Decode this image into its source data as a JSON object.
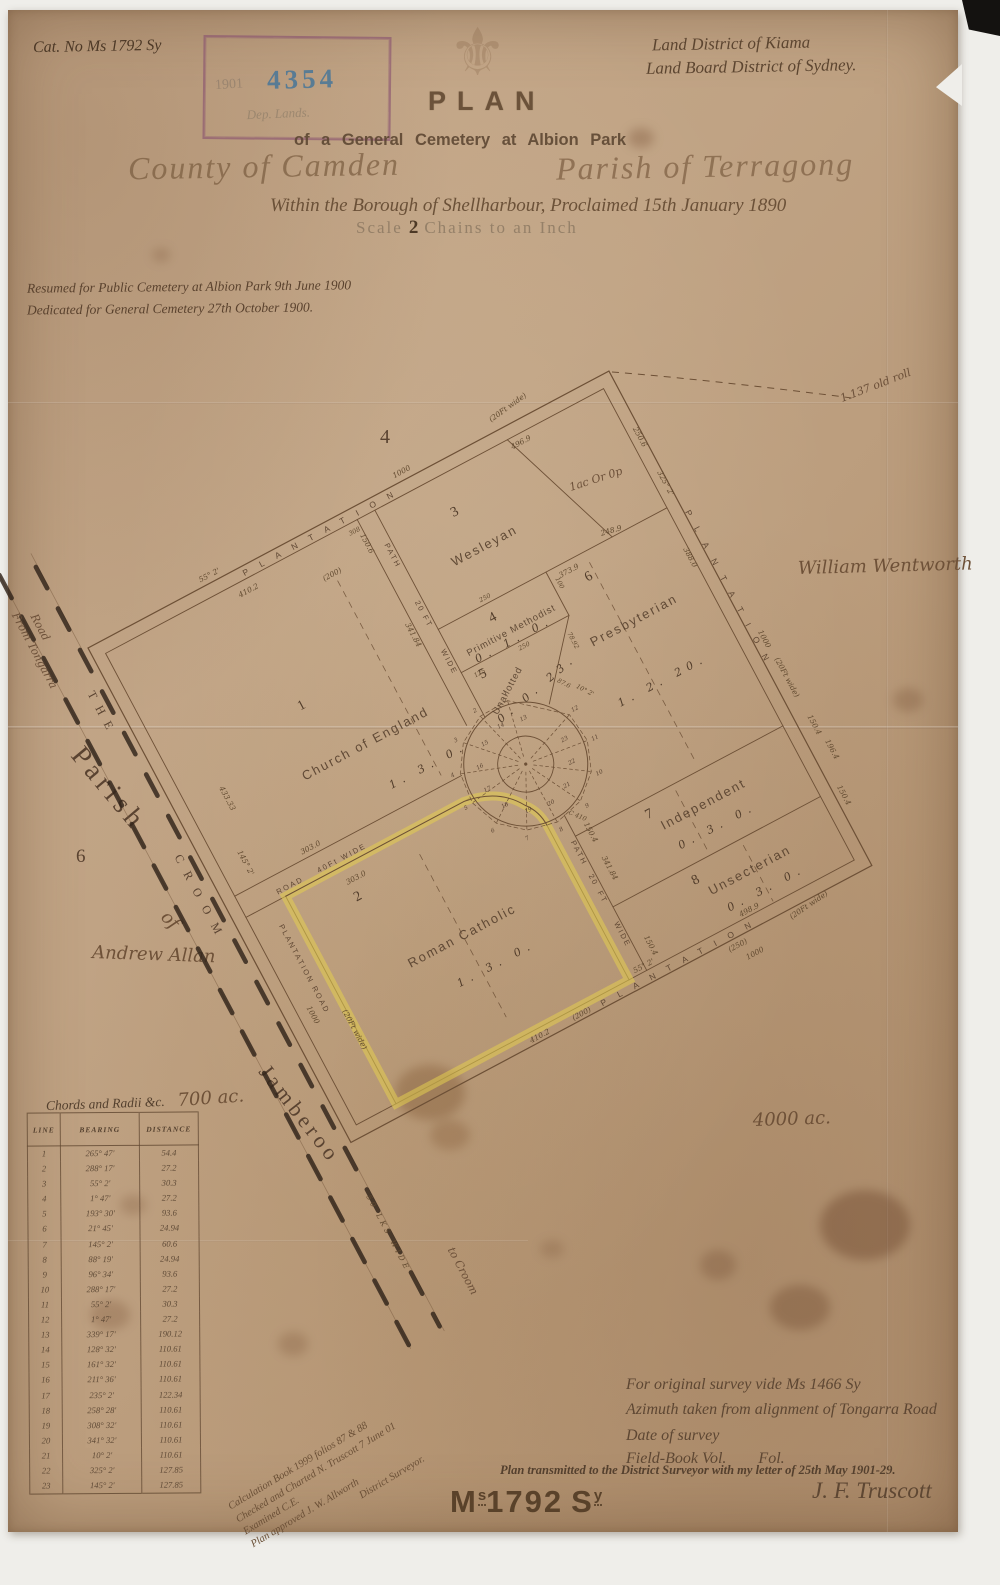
{
  "page": {
    "catalog_no": "Cat. No Ms 1792 Sy"
  },
  "icons": {
    "fleur": "⚜"
  },
  "stamp": {
    "year": "1901",
    "number": "4354",
    "dept": "Dep. Lands."
  },
  "header": {
    "district_line1": "Land District of Kiama",
    "district_line2": "Land Board District of Sydney.",
    "title": "PLAN",
    "subtitle": "of a General Cemetery at Albion Park",
    "county": "County of Camden",
    "parish": "Parish of Terragong",
    "borough": "Within the Borough of Shellharbour, Proclaimed 15th January 1890",
    "scale_label": "Scale",
    "scale_value": "2",
    "scale_units": "Chains to an Inch",
    "resumed": "Resumed for Public Cemetery at Albion Park 9th June 1900",
    "dedicated": "Dedicated for General Cemetery 27th October 1900."
  },
  "map": {
    "portion_number": "4",
    "old_roll_note": "1.137 old roll",
    "unnumbered_area": "1ac Or 0p",
    "adjoining": {
      "east_owner": "William Wentworth",
      "parish_label": "Parish",
      "parish_portion": "6",
      "of_label": "of",
      "west_owner": "Andrew Allan",
      "south_name": "Jamberoo",
      "area_west": "700 ac.",
      "area_south": "4000 ac."
    },
    "road": {
      "from_label1": "From Tongarra",
      "from_label2": "Road",
      "name_the": "THE",
      "name_croom": "CROOM",
      "width_label": "50 LKS WIDE",
      "to_label": "to Croom"
    },
    "plots": [
      {
        "num": "1",
        "name": "Church of England",
        "area": "1. 3. 0.",
        "note": "(200)"
      },
      {
        "num": "2",
        "name": "Roman Catholic",
        "area": "1. 3. 0."
      },
      {
        "num": "3",
        "name": "Wesleyan",
        "area": ""
      },
      {
        "num": "4",
        "name": "Primitive Methodist",
        "area": "0. 1. 0."
      },
      {
        "num": "5",
        "name": "Unallotted",
        "area": "0. 0. 23."
      },
      {
        "num": "6",
        "name": "Presbyterian",
        "area": "1. 2. 20."
      },
      {
        "num": "7",
        "name": "Independent",
        "area": "0. 3. 0."
      },
      {
        "num": "8",
        "name": "Unsecterian",
        "area": "0. 3. 0."
      }
    ],
    "edges": {
      "nw": {
        "bearing": "55° 2'",
        "plantation": "PLANTATION",
        "width": "(20Ft wide)",
        "length": "1000",
        "inner": "496.9",
        "plot1": "410.2",
        "d308": "308"
      },
      "ne": {
        "bearing": "325° 2'",
        "plantation": "PLANTATION",
        "width": "(20Ft wide)",
        "length": "1000",
        "d2506": "250.6",
        "d1504a": "150.4",
        "d1964": "196.4",
        "d1504b": "150.4",
        "d3880": "388.0"
      },
      "se": {
        "plantation": "PLANTATION",
        "width": "(20Ft wide)",
        "length": "1000",
        "bearing": "55° 2'",
        "d410": "410.2",
        "d200": "(200)",
        "d4989": "498.9",
        "d250": "(250)"
      },
      "sw": {
        "plantation": "PLANTATION ROAD",
        "width": "(20Ft wide)",
        "length": "1000",
        "d433": "433.33",
        "bearing": "145° 2'"
      }
    },
    "inner_road": {
      "d303a": "303.0",
      "name": "ROAD",
      "width": "40Ft WIDE",
      "d303b": "303.0"
    },
    "upper_path": {
      "d1506": "150.6",
      "w1": "PATH",
      "w2": "20 FT",
      "w3": "WIDE",
      "len": "341.84",
      "d308": "308"
    },
    "lower_path": {
      "w1": "PATH",
      "w2": "20",
      "w3": "FT",
      "w4": "WIDE",
      "len": "341.84",
      "d1504a": "150.4",
      "d1504b": "150.4",
      "c410": "C 410"
    },
    "dims": {
      "p4a": "250",
      "p4b": "250",
      "p4c": "100",
      "p5a": "125",
      "p5b": "78.92",
      "p5c": "87.6",
      "p5d": "10° 2'",
      "mid_a": "373.9",
      "mid_b": "248.9"
    },
    "circle_points": [
      "1",
      "2",
      "3",
      "4",
      "5",
      "6",
      "7",
      "8",
      "9",
      "10",
      "11",
      "12",
      "13",
      "14",
      "15",
      "16",
      "17",
      "18",
      "19",
      "20",
      "21",
      "22",
      "23"
    ]
  },
  "table": {
    "title": "Chords and Radii &c.",
    "col_line": "LINE",
    "col_bearing": "BEARING",
    "col_distance": "DISTANCE",
    "rows": [
      [
        "1",
        "265° 47'",
        "54.4"
      ],
      [
        "2",
        "288° 17'",
        "27.2"
      ],
      [
        "3",
        "55° 2'",
        "30.3"
      ],
      [
        "4",
        "1° 47'",
        "27.2"
      ],
      [
        "5",
        "193° 30'",
        "93.6"
      ],
      [
        "6",
        "21° 45'",
        "24.94"
      ],
      [
        "7",
        "145° 2'",
        "60.6"
      ],
      [
        "8",
        "88° 19'",
        "24.94"
      ],
      [
        "9",
        "96° 34'",
        "93.6"
      ],
      [
        "10",
        "288° 17'",
        "27.2"
      ],
      [
        "11",
        "55° 2'",
        "30.3"
      ],
      [
        "12",
        "1° 47'",
        "27.2"
      ],
      [
        "13",
        "339° 17'",
        "190.12"
      ],
      [
        "14",
        "128° 32'",
        "110.61"
      ],
      [
        "15",
        "161° 32'",
        "110.61"
      ],
      [
        "16",
        "211° 36'",
        "110.61"
      ],
      [
        "17",
        "235° 2'",
        "122.34"
      ],
      [
        "18",
        "258° 28'",
        "110.61"
      ],
      [
        "19",
        "308° 32'",
        "110.61"
      ],
      [
        "20",
        "341° 32'",
        "110.61"
      ],
      [
        "21",
        "10° 2'",
        "110.61"
      ],
      [
        "22",
        "325° 2'",
        "127.85"
      ],
      [
        "23",
        "145° 2'",
        "127.85"
      ]
    ]
  },
  "footer": {
    "vide": "For original survey vide Ms 1466 Sy",
    "azimuth": "Azimuth taken from alignment of Tongarra Road",
    "date": "Date of survey",
    "field_book": "Field-Book Vol.        Fol.",
    "transmitted": "Plan transmitted to the District Surveyor with my letter of 25th May 1901-29.",
    "signature": "J. F. Truscott",
    "calc_line1": "Calculation Book 1999 folios 87 & 88",
    "calc_line2": "Checked and Charted N. Truscott 7 June 01",
    "calc_line3": "Examined C.E.",
    "calc_line4": "Plan approved   J. W. Allworth",
    "calc_line5": "District Surveyor.",
    "stamp_m": "M",
    "stamp_s_sup": "s",
    "stamp_num": "1792",
    "stamp_s": "S",
    "stamp_y_sup": "y"
  }
}
